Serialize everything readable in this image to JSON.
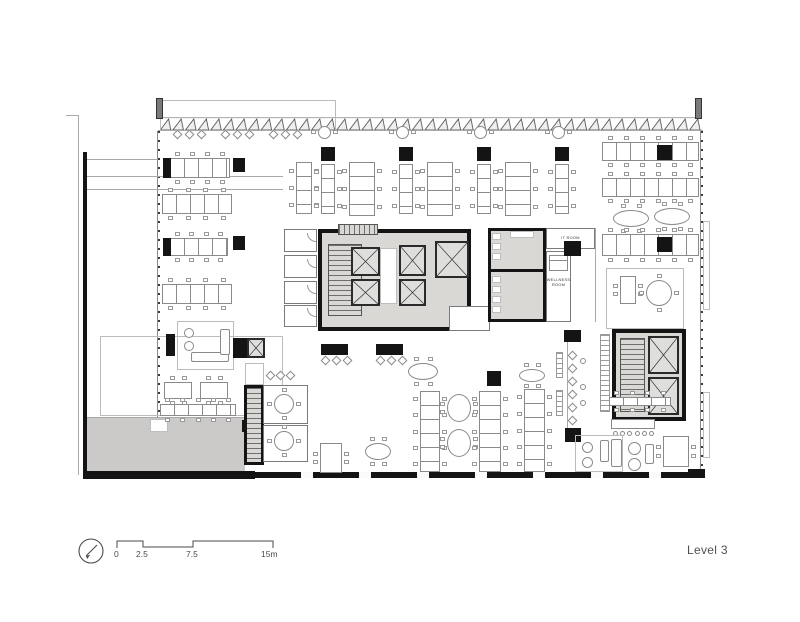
{
  "labels": {
    "level": "Level 3",
    "it_room": "IT ROOM",
    "wellness_1": "WELLNESS",
    "wellness_2": "ROOM"
  },
  "scale_bar": {
    "t0": "0",
    "t1": "2.5",
    "t2": "7.5",
    "t3": "15m"
  },
  "colors": {
    "wall": "#141414",
    "core_fill": "#d9d8d5",
    "terrace_fill": "#cbcac8",
    "drawing_line": "#8a8a8a"
  },
  "plan": {
    "items": [
      {
        "t": "line",
        "x": 66,
        "y": 115,
        "w": 13,
        "h": 1
      },
      {
        "t": "line",
        "x": 78,
        "y": 115,
        "w": 1,
        "h": 360
      },
      {
        "t": "roomt",
        "x": 160,
        "y": 100,
        "w": 176,
        "h": 31
      },
      {
        "t": "pier",
        "x": 156,
        "y": 98,
        "w": 7,
        "h": 21
      },
      {
        "t": "pier",
        "x": 695,
        "y": 98,
        "w": 7,
        "h": 21
      },
      {
        "t": "line",
        "x": 158,
        "y": 130,
        "w": 545,
        "h": 1
      },
      {
        "t": "ticksv",
        "x": 157,
        "y": 131,
        "w": 3,
        "h": 286
      },
      {
        "t": "ticksv",
        "x": 700,
        "y": 131,
        "w": 3,
        "h": 340
      },
      {
        "t": "roomt",
        "x": 703,
        "y": 221,
        "w": 7,
        "h": 89
      },
      {
        "t": "roomt",
        "x": 703,
        "y": 392,
        "w": 7,
        "h": 66
      },
      {
        "t": "line",
        "x": 85,
        "y": 159,
        "w": 73,
        "h": 1
      },
      {
        "t": "line",
        "x": 85,
        "y": 176,
        "w": 198,
        "h": 1
      },
      {
        "t": "line",
        "x": 85,
        "y": 189,
        "w": 198,
        "h": 1
      },
      {
        "t": "roomt",
        "x": 100,
        "y": 336,
        "w": 183,
        "h": 80
      },
      {
        "t": "gray",
        "x": 87,
        "y": 417,
        "w": 158,
        "h": 55
      },
      {
        "t": "line",
        "x": 87,
        "y": 417,
        "w": 158,
        "h": 1
      },
      {
        "t": "white",
        "x": 150,
        "y": 419,
        "w": 18,
        "h": 13
      },
      {
        "t": "blk",
        "x": 242,
        "y": 420,
        "w": 10,
        "h": 12
      },
      {
        "t": "blk",
        "x": 83,
        "y": 152,
        "w": 4,
        "h": 327
      },
      {
        "t": "blk",
        "x": 83,
        "y": 471,
        "w": 172,
        "h": 8
      },
      {
        "t": "glaz",
        "x": 255,
        "y": 472,
        "w": 447,
        "h": 6
      },
      {
        "t": "blk",
        "x": 688,
        "y": 469,
        "w": 17,
        "h": 9
      },
      {
        "t": "diam",
        "x": 174,
        "y": 131,
        "w": 7,
        "h": 7
      },
      {
        "t": "diam",
        "x": 186,
        "y": 131,
        "w": 7,
        "h": 7
      },
      {
        "t": "diam",
        "x": 198,
        "y": 131,
        "w": 7,
        "h": 7
      },
      {
        "t": "diam",
        "x": 222,
        "y": 131,
        "w": 7,
        "h": 7
      },
      {
        "t": "diam",
        "x": 234,
        "y": 131,
        "w": 7,
        "h": 7
      },
      {
        "t": "diam",
        "x": 246,
        "y": 131,
        "w": 7,
        "h": 7
      },
      {
        "t": "diam",
        "x": 270,
        "y": 131,
        "w": 7,
        "h": 7
      },
      {
        "t": "diam",
        "x": 282,
        "y": 131,
        "w": 7,
        "h": 7
      },
      {
        "t": "diam",
        "x": 294,
        "y": 131,
        "w": 7,
        "h": 7
      },
      {
        "t": "deskh",
        "x": 170,
        "y": 158,
        "w": 60,
        "h": 20
      },
      {
        "t": "blk",
        "x": 163,
        "y": 158,
        "w": 8,
        "h": 20
      },
      {
        "t": "blk",
        "x": 233,
        "y": 158,
        "w": 12,
        "h": 14
      },
      {
        "t": "deskh",
        "x": 162,
        "y": 194,
        "w": 70,
        "h": 20
      },
      {
        "t": "deskh",
        "x": 170,
        "y": 238,
        "w": 58,
        "h": 18
      },
      {
        "t": "blk",
        "x": 163,
        "y": 238,
        "w": 8,
        "h": 18
      },
      {
        "t": "blk",
        "x": 233,
        "y": 236,
        "w": 12,
        "h": 14
      },
      {
        "t": "deskh",
        "x": 162,
        "y": 284,
        "w": 70,
        "h": 20
      },
      {
        "t": "phone",
        "x": 318,
        "y": 126,
        "w": 13,
        "h": 13
      },
      {
        "t": "phone",
        "x": 396,
        "y": 126,
        "w": 13,
        "h": 13
      },
      {
        "t": "phone",
        "x": 474,
        "y": 126,
        "w": 13,
        "h": 13
      },
      {
        "t": "phone",
        "x": 552,
        "y": 126,
        "w": 13,
        "h": 13
      },
      {
        "t": "blk",
        "x": 321,
        "y": 147,
        "w": 14,
        "h": 14
      },
      {
        "t": "blk",
        "x": 399,
        "y": 147,
        "w": 14,
        "h": 14
      },
      {
        "t": "blk",
        "x": 477,
        "y": 147,
        "w": 14,
        "h": 14
      },
      {
        "t": "blk",
        "x": 555,
        "y": 147,
        "w": 14,
        "h": 14
      },
      {
        "t": "deskv",
        "x": 296,
        "y": 162,
        "w": 16,
        "h": 52
      },
      {
        "t": "deskv",
        "x": 321,
        "y": 164,
        "w": 14,
        "h": 50
      },
      {
        "t": "deskv",
        "x": 349,
        "y": 162,
        "w": 26,
        "h": 54
      },
      {
        "t": "deskv",
        "x": 399,
        "y": 164,
        "w": 14,
        "h": 50
      },
      {
        "t": "deskv",
        "x": 427,
        "y": 162,
        "w": 26,
        "h": 54
      },
      {
        "t": "deskv",
        "x": 477,
        "y": 164,
        "w": 14,
        "h": 50
      },
      {
        "t": "deskv",
        "x": 505,
        "y": 162,
        "w": 26,
        "h": 54
      },
      {
        "t": "deskv",
        "x": 555,
        "y": 164,
        "w": 14,
        "h": 50
      },
      {
        "t": "deskh",
        "x": 602,
        "y": 142,
        "w": 97,
        "h": 19
      },
      {
        "t": "blk",
        "x": 657,
        "y": 145,
        "w": 15,
        "h": 15
      },
      {
        "t": "deskh",
        "x": 602,
        "y": 178,
        "w": 97,
        "h": 19
      },
      {
        "t": "oval",
        "x": 613,
        "y": 210,
        "w": 36,
        "h": 17
      },
      {
        "t": "oval",
        "x": 654,
        "y": 208,
        "w": 36,
        "h": 17
      },
      {
        "t": "deskh",
        "x": 602,
        "y": 234,
        "w": 97,
        "h": 22
      },
      {
        "t": "blk",
        "x": 657,
        "y": 237,
        "w": 15,
        "h": 15
      },
      {
        "t": "roomt",
        "x": 606,
        "y": 268,
        "w": 78,
        "h": 61
      },
      {
        "t": "rect",
        "x": 620,
        "y": 276,
        "w": 16,
        "h": 28
      },
      {
        "t": "roundt",
        "x": 646,
        "y": 280,
        "w": 26,
        "h": 26
      },
      {
        "t": "room",
        "x": 284,
        "y": 229,
        "w": 33,
        "h": 23
      },
      {
        "t": "room",
        "x": 284,
        "y": 255,
        "w": 33,
        "h": 23
      },
      {
        "t": "room",
        "x": 284,
        "y": 281,
        "w": 33,
        "h": 23
      },
      {
        "t": "room",
        "x": 284,
        "y": 305,
        "w": 33,
        "h": 22
      },
      {
        "t": "arc",
        "x": 307,
        "y": 233,
        "w": 9,
        "h": 9
      },
      {
        "t": "arc",
        "x": 307,
        "y": 259,
        "w": 9,
        "h": 9
      },
      {
        "t": "arc",
        "x": 307,
        "y": 285,
        "w": 9,
        "h": 9
      },
      {
        "t": "arc",
        "x": 307,
        "y": 308,
        "w": 9,
        "h": 9
      },
      {
        "t": "core",
        "x": 318,
        "y": 229,
        "w": 153,
        "h": 102
      },
      {
        "t": "stairh",
        "x": 338,
        "y": 224,
        "w": 40,
        "h": 11
      },
      {
        "t": "stairv",
        "x": 328,
        "y": 244,
        "w": 34,
        "h": 72
      },
      {
        "t": "white",
        "x": 380,
        "y": 248,
        "w": 17,
        "h": 56
      },
      {
        "t": "elev",
        "x": 351,
        "y": 247,
        "w": 29,
        "h": 29
      },
      {
        "t": "elev",
        "x": 351,
        "y": 279,
        "w": 29,
        "h": 27
      },
      {
        "t": "elev",
        "x": 399,
        "y": 245,
        "w": 27,
        "h": 31
      },
      {
        "t": "elev",
        "x": 399,
        "y": 279,
        "w": 27,
        "h": 27
      },
      {
        "t": "elev",
        "x": 435,
        "y": 241,
        "w": 34,
        "h": 37
      },
      {
        "t": "room",
        "x": 449,
        "y": 306,
        "w": 41,
        "h": 25
      },
      {
        "t": "core3",
        "x": 488,
        "y": 228,
        "w": 58,
        "h": 94
      },
      {
        "t": "blk",
        "x": 488,
        "y": 269,
        "w": 58,
        "h": 3
      },
      {
        "t": "white",
        "x": 492,
        "y": 233,
        "w": 9,
        "h": 7
      },
      {
        "t": "white",
        "x": 492,
        "y": 243,
        "w": 9,
        "h": 7
      },
      {
        "t": "white",
        "x": 492,
        "y": 253,
        "w": 9,
        "h": 7
      },
      {
        "t": "white",
        "x": 510,
        "y": 231,
        "w": 24,
        "h": 7
      },
      {
        "t": "white",
        "x": 492,
        "y": 276,
        "w": 9,
        "h": 7
      },
      {
        "t": "white",
        "x": 492,
        "y": 286,
        "w": 9,
        "h": 7
      },
      {
        "t": "white",
        "x": 492,
        "y": 296,
        "w": 9,
        "h": 7
      },
      {
        "t": "white",
        "x": 492,
        "y": 306,
        "w": 9,
        "h": 7
      },
      {
        "t": "room",
        "x": 546,
        "y": 228,
        "w": 49,
        "h": 21
      },
      {
        "t": "room",
        "x": 546,
        "y": 251,
        "w": 25,
        "h": 71
      },
      {
        "t": "bed",
        "x": 549,
        "y": 255,
        "w": 19,
        "h": 16
      },
      {
        "t": "blk",
        "x": 564,
        "y": 241,
        "w": 17,
        "h": 15
      },
      {
        "t": "line",
        "x": 595,
        "y": 228,
        "w": 1,
        "h": 94
      },
      {
        "t": "roomt",
        "x": 177,
        "y": 321,
        "w": 57,
        "h": 49
      },
      {
        "t": "circ",
        "x": 184,
        "y": 328,
        "w": 10,
        "h": 10
      },
      {
        "t": "circ",
        "x": 184,
        "y": 341,
        "w": 10,
        "h": 10
      },
      {
        "t": "sofa",
        "x": 191,
        "y": 352,
        "w": 38,
        "h": 10
      },
      {
        "t": "sofa",
        "x": 220,
        "y": 329,
        "w": 10,
        "h": 26
      },
      {
        "t": "blk",
        "x": 166,
        "y": 334,
        "w": 9,
        "h": 22
      },
      {
        "t": "blk",
        "x": 233,
        "y": 338,
        "w": 14,
        "h": 20
      },
      {
        "t": "elev",
        "x": 247,
        "y": 338,
        "w": 18,
        "h": 20
      },
      {
        "t": "blk",
        "x": 321,
        "y": 344,
        "w": 27,
        "h": 11
      },
      {
        "t": "blk",
        "x": 376,
        "y": 344,
        "w": 27,
        "h": 11
      },
      {
        "t": "diam",
        "x": 322,
        "y": 357,
        "w": 7,
        "h": 7
      },
      {
        "t": "diam",
        "x": 333,
        "y": 357,
        "w": 7,
        "h": 7
      },
      {
        "t": "diam",
        "x": 344,
        "y": 357,
        "w": 7,
        "h": 7
      },
      {
        "t": "diam",
        "x": 377,
        "y": 357,
        "w": 7,
        "h": 7
      },
      {
        "t": "diam",
        "x": 388,
        "y": 357,
        "w": 7,
        "h": 7
      },
      {
        "t": "diam",
        "x": 399,
        "y": 357,
        "w": 7,
        "h": 7
      },
      {
        "t": "oval",
        "x": 408,
        "y": 363,
        "w": 30,
        "h": 17
      },
      {
        "t": "rect",
        "x": 164,
        "y": 382,
        "w": 28,
        "h": 17
      },
      {
        "t": "rect",
        "x": 200,
        "y": 382,
        "w": 28,
        "h": 17
      },
      {
        "t": "deskh",
        "x": 160,
        "y": 404,
        "w": 76,
        "h": 12
      },
      {
        "t": "roomt",
        "x": 245,
        "y": 363,
        "w": 19,
        "h": 22
      },
      {
        "t": "stairb",
        "x": 244,
        "y": 385,
        "w": 20,
        "h": 80
      },
      {
        "t": "room",
        "x": 263,
        "y": 385,
        "w": 45,
        "h": 39
      },
      {
        "t": "room",
        "x": 263,
        "y": 425,
        "w": 45,
        "h": 37
      },
      {
        "t": "roundt",
        "x": 274,
        "y": 394,
        "w": 20,
        "h": 20
      },
      {
        "t": "roundt",
        "x": 274,
        "y": 431,
        "w": 20,
        "h": 20
      },
      {
        "t": "diam",
        "x": 267,
        "y": 372,
        "w": 7,
        "h": 7
      },
      {
        "t": "diam",
        "x": 277,
        "y": 372,
        "w": 7,
        "h": 7
      },
      {
        "t": "diam",
        "x": 287,
        "y": 372,
        "w": 7,
        "h": 7
      },
      {
        "t": "rect",
        "x": 320,
        "y": 443,
        "w": 22,
        "h": 30
      },
      {
        "t": "oval",
        "x": 365,
        "y": 443,
        "w": 26,
        "h": 17
      },
      {
        "t": "deskv",
        "x": 420,
        "y": 391,
        "w": 20,
        "h": 81
      },
      {
        "t": "oval",
        "x": 447,
        "y": 394,
        "w": 24,
        "h": 28
      },
      {
        "t": "oval",
        "x": 447,
        "y": 429,
        "w": 24,
        "h": 28
      },
      {
        "t": "deskv",
        "x": 479,
        "y": 391,
        "w": 22,
        "h": 81
      },
      {
        "t": "blk",
        "x": 487,
        "y": 371,
        "w": 14,
        "h": 15
      },
      {
        "t": "oval",
        "x": 519,
        "y": 369,
        "w": 26,
        "h": 13
      },
      {
        "t": "deskv",
        "x": 524,
        "y": 389,
        "w": 21,
        "h": 83
      },
      {
        "t": "blk",
        "x": 564,
        "y": 330,
        "w": 17,
        "h": 12
      },
      {
        "t": "blk",
        "x": 565,
        "y": 428,
        "w": 16,
        "h": 14
      },
      {
        "t": "line",
        "x": 567,
        "y": 342,
        "w": 1,
        "h": 86
      },
      {
        "t": "diam",
        "x": 569,
        "y": 352,
        "w": 7,
        "h": 7
      },
      {
        "t": "diam",
        "x": 569,
        "y": 365,
        "w": 7,
        "h": 7
      },
      {
        "t": "diam",
        "x": 569,
        "y": 378,
        "w": 7,
        "h": 7
      },
      {
        "t": "diam",
        "x": 569,
        "y": 391,
        "w": 7,
        "h": 7
      },
      {
        "t": "diam",
        "x": 569,
        "y": 404,
        "w": 7,
        "h": 7
      },
      {
        "t": "diam",
        "x": 569,
        "y": 417,
        "w": 7,
        "h": 7
      },
      {
        "t": "circ",
        "x": 580,
        "y": 358,
        "w": 6,
        "h": 6
      },
      {
        "t": "circ",
        "x": 580,
        "y": 384,
        "w": 6,
        "h": 6
      },
      {
        "t": "circ",
        "x": 580,
        "y": 400,
        "w": 6,
        "h": 6
      },
      {
        "t": "lockers",
        "x": 556,
        "y": 352,
        "w": 7,
        "h": 26
      },
      {
        "t": "lockers",
        "x": 556,
        "y": 390,
        "w": 7,
        "h": 26
      },
      {
        "t": "core",
        "x": 612,
        "y": 329,
        "w": 74,
        "h": 92
      },
      {
        "t": "stairv",
        "x": 620,
        "y": 338,
        "w": 25,
        "h": 74
      },
      {
        "t": "elev",
        "x": 648,
        "y": 336,
        "w": 31,
        "h": 38
      },
      {
        "t": "elev",
        "x": 648,
        "y": 377,
        "w": 31,
        "h": 38
      },
      {
        "t": "lockers",
        "x": 600,
        "y": 334,
        "w": 10,
        "h": 78
      },
      {
        "t": "deskh",
        "x": 609,
        "y": 397,
        "w": 62,
        "h": 9
      },
      {
        "t": "counter",
        "x": 611,
        "y": 419,
        "w": 44,
        "h": 10
      },
      {
        "t": "roomt",
        "x": 575,
        "y": 435,
        "w": 48,
        "h": 37
      },
      {
        "t": "circ",
        "x": 582,
        "y": 442,
        "w": 11,
        "h": 11
      },
      {
        "t": "circ",
        "x": 582,
        "y": 457,
        "w": 11,
        "h": 11
      },
      {
        "t": "sofa",
        "x": 600,
        "y": 440,
        "w": 9,
        "h": 22
      },
      {
        "t": "sofa",
        "x": 611,
        "y": 439,
        "w": 11,
        "h": 28
      },
      {
        "t": "circ",
        "x": 628,
        "y": 442,
        "w": 13,
        "h": 13
      },
      {
        "t": "circ",
        "x": 628,
        "y": 458,
        "w": 13,
        "h": 13
      },
      {
        "t": "sofa",
        "x": 645,
        "y": 444,
        "w": 9,
        "h": 20
      },
      {
        "t": "rect",
        "x": 663,
        "y": 436,
        "w": 26,
        "h": 31
      }
    ]
  }
}
